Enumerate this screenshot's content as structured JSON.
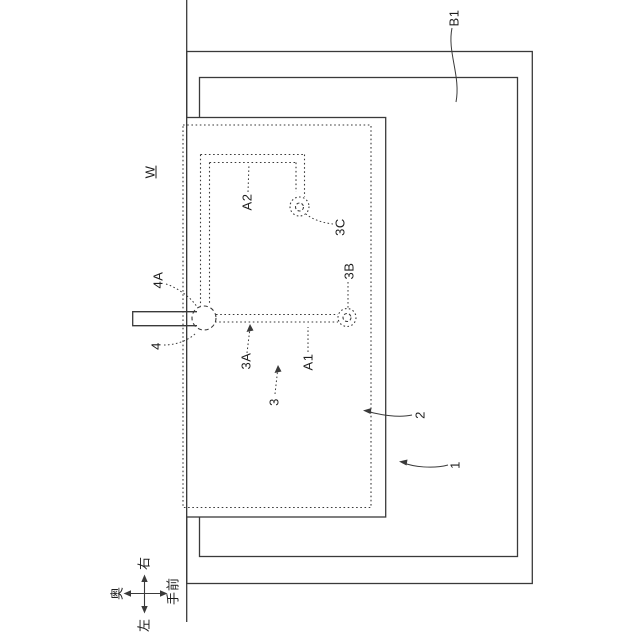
{
  "figure": {
    "description": "Patent-style top-view technical drawing; all text rotated 90 degrees counter-clockwise (reads bottom-to-top)",
    "ink_color": "#3a3a3a",
    "background_color": "#ffffff"
  },
  "reference_labels": {
    "b1": "B1",
    "w": "W",
    "a2": "A2",
    "c3": "3C",
    "b3": "3B",
    "a4": "4A",
    "n4": "4",
    "a3": "3A",
    "a1": "A1",
    "n3": "3",
    "n2": "2",
    "n1": "1"
  },
  "compass": {
    "up": "右",
    "left": "奥",
    "down": "左",
    "right": "手前"
  }
}
